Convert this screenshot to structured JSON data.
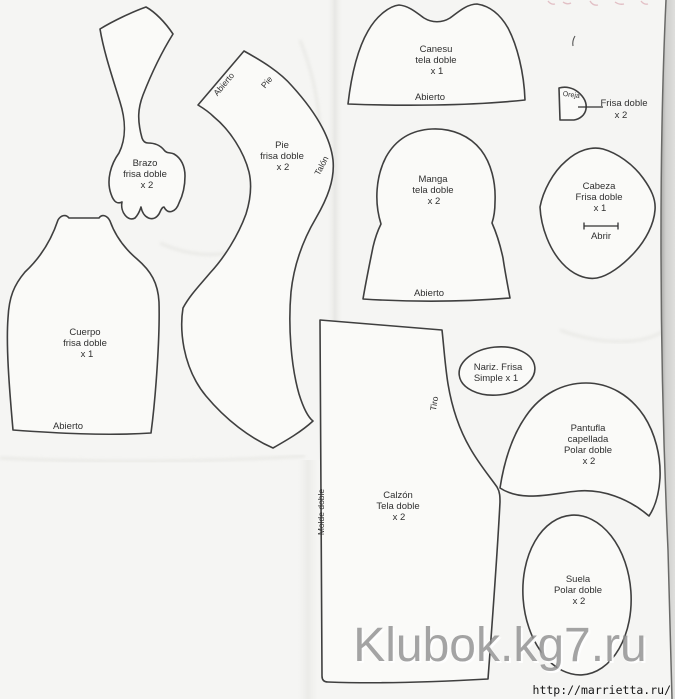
{
  "pieces": {
    "brazo": {
      "title": "Brazo",
      "material": "frisa doble",
      "quantity": "x 2"
    },
    "pie": {
      "title": "Pie",
      "material": "frisa doble",
      "quantity": "x 2",
      "edge_top": "Abierto",
      "edge_side": "Pie",
      "edge_heel": "Talón"
    },
    "cuerpo": {
      "title": "Cuerpo",
      "material": "frisa doble",
      "quantity": "x 1",
      "edge_bottom": "Abierto"
    },
    "canesu": {
      "title": "Canesu",
      "material": "tela doble",
      "quantity": "x 1",
      "edge_bottom": "Abierto"
    },
    "oreja": {
      "title": "Oreja",
      "material": "Frisa doble",
      "quantity": "x 2"
    },
    "manga": {
      "title": "Manga",
      "material": "tela doble",
      "quantity": "x 2",
      "edge_bottom": "Abierto"
    },
    "cabeza": {
      "title": "Cabeza",
      "material": "Frisa doble",
      "quantity": "x 1",
      "opening": "Abrir"
    },
    "nariz": {
      "title": "Nariz. Frisa",
      "quantity": "Simple x 1"
    },
    "calzon": {
      "title": "Calzón",
      "material": "Tela doble",
      "quantity": "x 2",
      "edge_curve": "Tiro",
      "edge_fold": "Molde doble"
    },
    "pantufla": {
      "title": "Pantufla",
      "subtitle": "capellada",
      "material": "Polar doble",
      "quantity": "x 2"
    },
    "suela": {
      "title": "Suela",
      "material": "Polar doble",
      "quantity": "x 2"
    }
  },
  "watermark": {
    "text": "Klubok.kg7.ru"
  },
  "footer": {
    "url": "http://marrietta.ru/"
  },
  "colors": {
    "paper": "#f5f5f3",
    "piece_fill": "#fafaf8",
    "outline": "#3f3f3f",
    "label": "#2f2f2f",
    "watermark_gray": "#8e8e8e",
    "scanner_strip": "#c2c2c0",
    "pink_fragment": "#d8a4ae"
  }
}
